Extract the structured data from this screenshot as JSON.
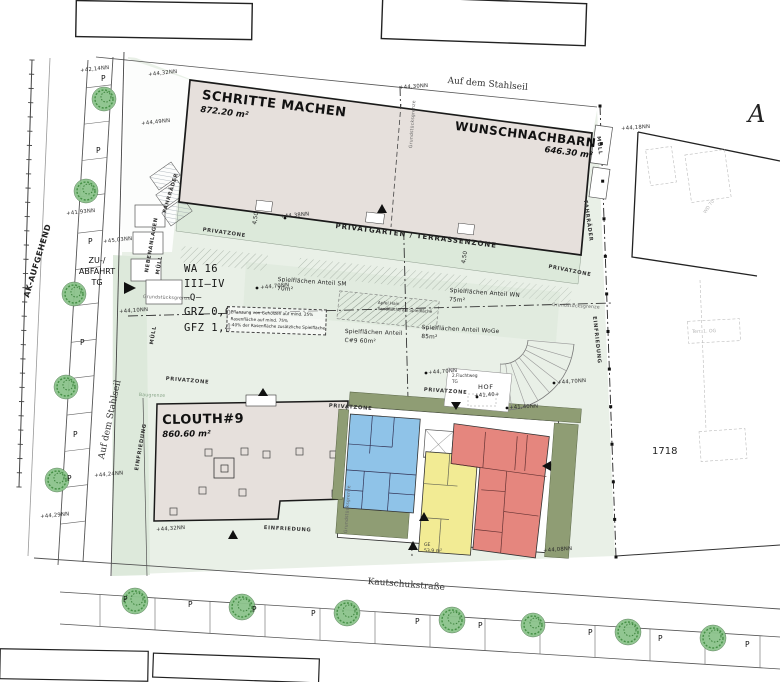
{
  "streets": {
    "top": "Auf dem Stahlseil",
    "left": "Auf dem Stahlseil",
    "left_upper": "AK-AUFGEHEND",
    "bottom": "Kautschukstraße"
  },
  "parcel": {
    "number": "1718",
    "section_letter": "A"
  },
  "buildings": {
    "schritte_machen": {
      "name": "SCHRITTE MACHEN",
      "area": "872.20 m²"
    },
    "wunschnachbarn": {
      "name": "WUNSCHNACHBARN",
      "area": "646.30 m²"
    },
    "clouth9": {
      "name": "CLOUTH#9",
      "area": "860.60 m²"
    }
  },
  "planning": {
    "zone": "WA 16",
    "floors": "III–IV",
    "center_mark": "–Q–",
    "grz": "GRZ 0,6",
    "gfz": "GFZ 1,4"
  },
  "note": {
    "line1": "Pflanzung von Gehölzen auf mind. 25%",
    "line2": "Rasenfläche auf mind. 75%",
    "line3": "-40% der Rasenfläche zusätzliche Spielfläche"
  },
  "zones": {
    "privatgarten": "PRIVATGARTEN / TERRASSENZONE",
    "privatzone": "PRIVATZONE",
    "nebenanlagen": "NEBENANLAGEN",
    "fahrraeder": "FAHRRÄDER",
    "muell": "MÜLL",
    "einfriedung": "EINFRIEDUNG",
    "grenze": "Grundstücksgrenze",
    "baugrenze": "Baugrenze",
    "hof": "HOF",
    "fluchtweg_1": "2.Fluchtweg",
    "fluchtweg_2": "TG",
    "zufahrt_1": "ZU-/",
    "zufahrt_2": "ABFAHRT",
    "zufahrt_3": "TG",
    "ge": "GE",
    "ge_area": "53,9 m²",
    "dim_450": "4,50",
    "parking": "P",
    "center_1": "Apfel Hain",
    "center_2": "Sandfläche als Spielfläche"
  },
  "spielflaechen": [
    {
      "label": "Spielflächen Anteil SM",
      "area": "70m²",
      "x": 278,
      "y": 276,
      "r": 4
    },
    {
      "label": "Spielflächen Anteil WN",
      "area": "75m²",
      "x": 450,
      "y": 287,
      "r": 4
    },
    {
      "label": "Spielflächen Anteil",
      "area": "C#9  60m²",
      "x": 345,
      "y": 328,
      "r": 2
    },
    {
      "label": "Spielflächen Anteil WoGe",
      "area": "85m²",
      "x": 422,
      "y": 324,
      "r": 3
    }
  ],
  "markers": [
    {
      "text": "+42,14NN",
      "x": 80,
      "y": 68,
      "r": -6
    },
    {
      "text": "+44,32NN",
      "x": 148,
      "y": 72,
      "r": -6
    },
    {
      "text": "+44,49NN",
      "x": 141,
      "y": 121,
      "r": -6
    },
    {
      "text": "+44,30NN",
      "x": 399,
      "y": 85,
      "r": -4
    },
    {
      "text": "+44,18NN",
      "x": 621,
      "y": 126,
      "r": -4
    },
    {
      "text": "+41,93NN",
      "x": 66,
      "y": 211,
      "r": -6
    },
    {
      "text": "+45,03NN",
      "x": 103,
      "y": 239,
      "r": -6
    },
    {
      "text": "+44,10NN",
      "x": 119,
      "y": 309,
      "r": -4
    },
    {
      "text": "+44,38NN",
      "x": 280,
      "y": 214,
      "r": -5
    },
    {
      "text": "+44,70NN",
      "x": 260,
      "y": 285,
      "r": -5
    },
    {
      "text": "+44,70NN",
      "x": 428,
      "y": 370,
      "r": -4
    },
    {
      "text": "+44,70NN",
      "x": 557,
      "y": 380,
      "r": -4
    },
    {
      "text": "+41,40+",
      "x": 474,
      "y": 393,
      "r": -3
    },
    {
      "text": "+41,40NN",
      "x": 509,
      "y": 405,
      "r": -3
    },
    {
      "text": "+44,24NN",
      "x": 94,
      "y": 473,
      "r": -5
    },
    {
      "text": "+44,29NN",
      "x": 40,
      "y": 514,
      "r": -5
    },
    {
      "text": "+44,32NN",
      "x": 156,
      "y": 527,
      "r": -4
    },
    {
      "text": "+44,08NN",
      "x": 543,
      "y": 548,
      "r": -4
    }
  ],
  "zone_instances": [
    {
      "key": "privatzone",
      "x": 203,
      "y": 227,
      "r": 8
    },
    {
      "key": "privatzone",
      "x": 549,
      "y": 264,
      "r": 11
    },
    {
      "key": "privatzone",
      "x": 166,
      "y": 376,
      "r": 5
    },
    {
      "key": "privatzone",
      "x": 329,
      "y": 403,
      "r": 4
    },
    {
      "key": "privatzone",
      "x": 424,
      "y": 387,
      "r": 4
    },
    {
      "key": "nebenanlagen",
      "x": 144,
      "y": 272,
      "r": -80
    },
    {
      "key": "fahrraeder",
      "x": 162,
      "y": 212,
      "r": -73
    },
    {
      "key": "fahrraeder",
      "x": 588,
      "y": 200,
      "r": 82
    },
    {
      "key": "muell",
      "x": 155,
      "y": 274,
      "r": -80
    },
    {
      "key": "muell",
      "x": 149,
      "y": 344,
      "r": -80
    },
    {
      "key": "muell",
      "x": 601,
      "y": 136,
      "r": 84
    },
    {
      "key": "einfriedung",
      "x": 134,
      "y": 470,
      "r": -80
    },
    {
      "key": "einfriedung",
      "x": 264,
      "y": 525,
      "r": 3
    },
    {
      "key": "einfriedung",
      "x": 597,
      "y": 316,
      "r": 84
    },
    {
      "key": "grenze",
      "x": 409,
      "y": 148,
      "r": -86
    },
    {
      "key": "grenze",
      "x": 143,
      "y": 295,
      "r": 2
    },
    {
      "key": "grenze",
      "x": 552,
      "y": 303,
      "r": 3
    },
    {
      "key": "grenze",
      "x": 344,
      "y": 533,
      "r": -86
    },
    {
      "key": "baugrenze",
      "x": 139,
      "y": 393,
      "r": 2
    },
    {
      "key": "dim_450",
      "x": 252,
      "y": 224,
      "r": -80
    },
    {
      "key": "dim_450",
      "x": 461,
      "y": 263,
      "r": -80
    }
  ],
  "parking_positions": [
    [
      101,
      74
    ],
    [
      96,
      146
    ],
    [
      88,
      237
    ],
    [
      80,
      338
    ],
    [
      73,
      430
    ],
    [
      67,
      474
    ],
    [
      123,
      595
    ],
    [
      188,
      600
    ],
    [
      252,
      605
    ],
    [
      311,
      609
    ],
    [
      415,
      617
    ],
    [
      478,
      621
    ],
    [
      588,
      628
    ],
    [
      658,
      634
    ],
    [
      745,
      640
    ]
  ],
  "neighbor": {
    "label_a": "WD 70",
    "label_b": "Terr. 1. OG"
  },
  "colors": {
    "site_green": "#e9f0e7",
    "band_green": "#dce9da",
    "olive": "#8f9d74",
    "building_beige": "#e6e0dc",
    "unit_blue": "#8fc3e8",
    "unit_yellow": "#f2eb94",
    "unit_red": "#e5867e",
    "tree_green": "#8cc48c"
  }
}
